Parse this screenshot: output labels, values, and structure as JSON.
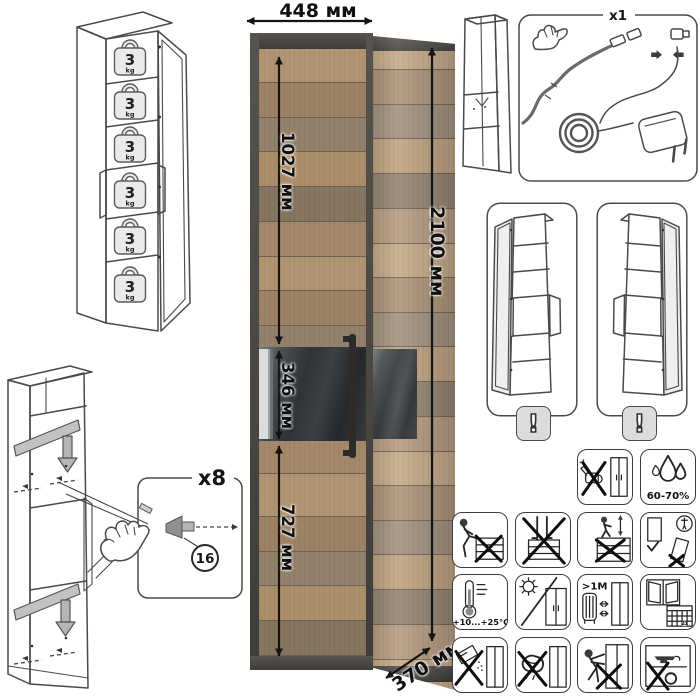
{
  "product": {
    "width_label": "448 мм",
    "height_label": "2100 мм",
    "depth_label": "370 мм",
    "upper_section_label": "1027 мм",
    "glass_section_label": "346 мм",
    "lower_section_label": "727 мм"
  },
  "shelf_load": {
    "value": "3",
    "unit": "kg"
  },
  "led_kit": {
    "quantity_label": "x1"
  },
  "shelf_pins": {
    "quantity_label": "x8",
    "part_number": "16"
  },
  "door_reversal": {
    "warning_mark": "!"
  },
  "care": {
    "humidity": "60-70%",
    "temperature": "+10...+25°C",
    "heat_distance": ">1М",
    "calendar_day": "21"
  }
}
